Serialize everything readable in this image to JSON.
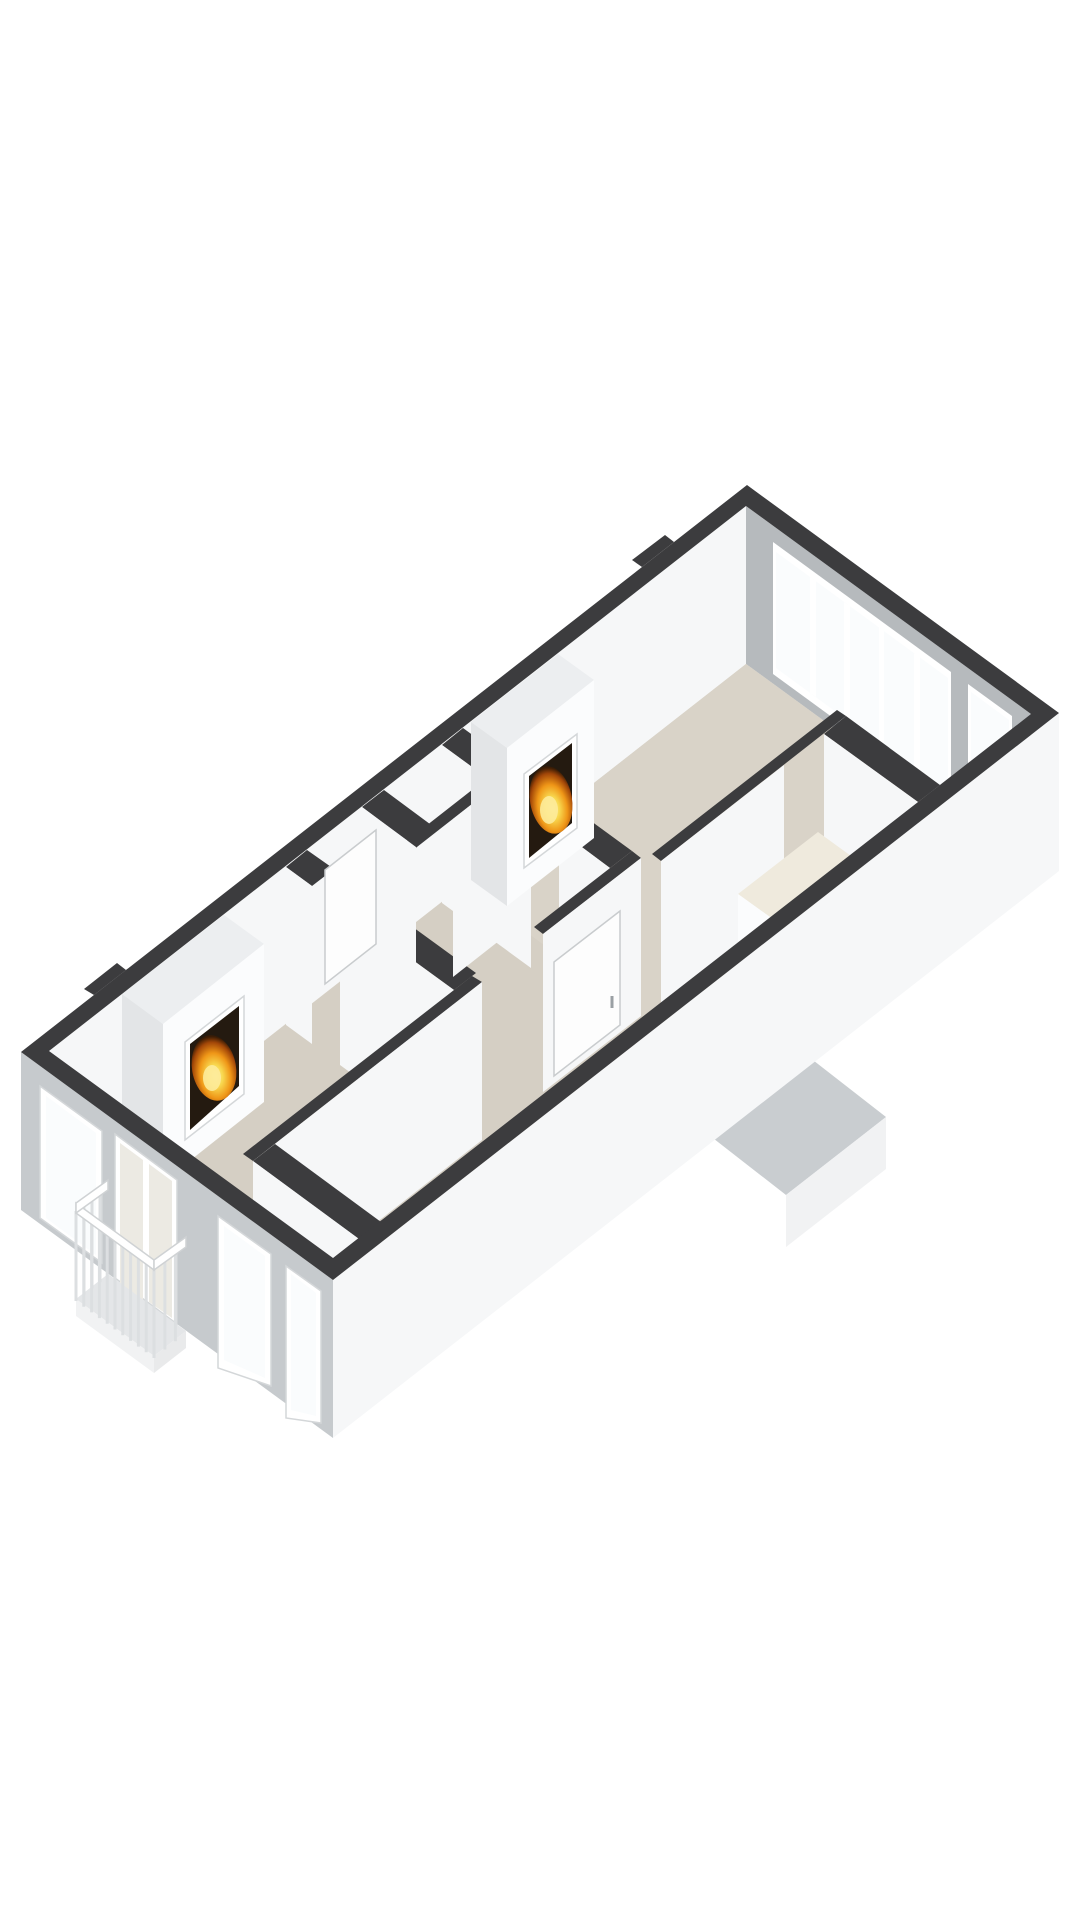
{
  "scene": {
    "type": "floorplan-3d",
    "view": "isometric-birdseye",
    "background": "#ffffff",
    "storey_elements": [
      "two large rooms each with a burning fireplace",
      "central hallway with small rooms",
      "window band on far end wall",
      "balcony with french doors on near facade",
      "roof element outside lower wall"
    ]
  },
  "colors": {
    "wall_top": "#3c3c3e",
    "wall_top_light": "#eceef0",
    "wall_face_white": "#f6f7f8",
    "wall_face_shade": "#e3e5e7",
    "interior_gray": "#b6babd",
    "exterior_white": "#f6f7f8",
    "facade_gray": "#c6cacd",
    "floor": "#d5cfc4",
    "floor_upper": "#d9d3c8",
    "floor_closet": "#e9e4d8",
    "counter": "#efeadd",
    "glass": "#fafcfd",
    "frame": "#ffffff",
    "balcony_slab": "#e4e6e8",
    "roof_gray": "#c9cdd0",
    "fire_dark": "#241a10",
    "flame_outer": "#c25a10",
    "flame_mid": "#ef9617",
    "flame_core": "#f8d84f"
  },
  "features": [
    {
      "name": "outer-walls"
    },
    {
      "name": "upper-room"
    },
    {
      "name": "lower-living-room"
    },
    {
      "name": "hallway"
    },
    {
      "name": "storage-closet"
    },
    {
      "name": "corridor"
    },
    {
      "name": "fireplace-upper"
    },
    {
      "name": "fireplace-lower"
    },
    {
      "name": "window-band"
    },
    {
      "name": "corner-window"
    },
    {
      "name": "facade-windows"
    },
    {
      "name": "french-doors"
    },
    {
      "name": "balcony"
    },
    {
      "name": "roof-element"
    }
  ]
}
